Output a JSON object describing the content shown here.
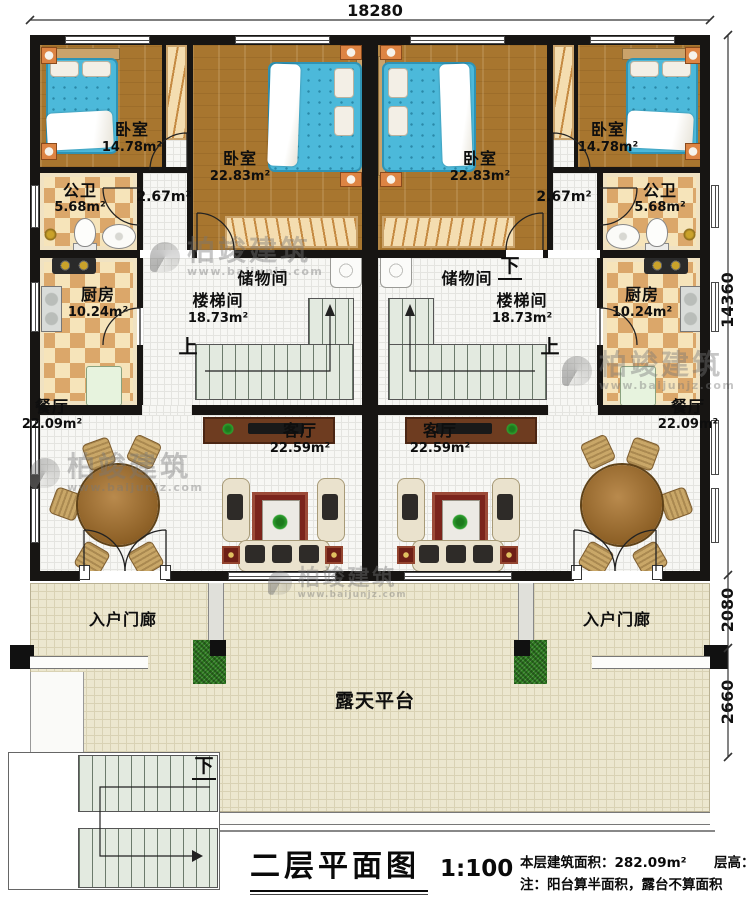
{
  "dimensions": {
    "top": "18280",
    "side_main": "14360",
    "side_porch": "2080",
    "side_terrace": "2660"
  },
  "rooms": {
    "bedroom_small": {
      "name": "卧室",
      "area": "14.78m²"
    },
    "bedroom_large": {
      "name": "卧室",
      "area": "22.83m²"
    },
    "bathroom": {
      "name": "公卫",
      "area": "5.68m²"
    },
    "landing": {
      "area": "2.67m²"
    },
    "kitchen": {
      "name": "厨房",
      "area": "10.24m²"
    },
    "storage": {
      "name": "储物间"
    },
    "stairwell": {
      "name": "楼梯间",
      "area": "18.73m²"
    },
    "dining": {
      "name": "餐厅",
      "area": "22.09m²"
    },
    "living": {
      "name": "客厅",
      "area": "22.59m²"
    },
    "porch": {
      "name": "入户门廊"
    },
    "terrace": {
      "name": "露天平台"
    }
  },
  "marks": {
    "up": "上",
    "down": "下"
  },
  "watermark": {
    "brand": "柏竣建筑",
    "url": "www.baijunjz.com"
  },
  "titleblock": {
    "title": "二层平面图",
    "scale": "1:100",
    "area_label": "本层建筑面积：",
    "area_value": "282.09m²",
    "height_label": "层高：",
    "height_value": "3.6m",
    "note": "注：阳台算半面积，露台不算面积"
  },
  "colors": {
    "wall": "#171513",
    "wood_floor": "#a8762f",
    "mattress": "#4cb9da",
    "tile_accent": "#dba76a",
    "stair": "#e3eae0",
    "terrace": "#ece7cf",
    "rug": "#7b241c"
  }
}
